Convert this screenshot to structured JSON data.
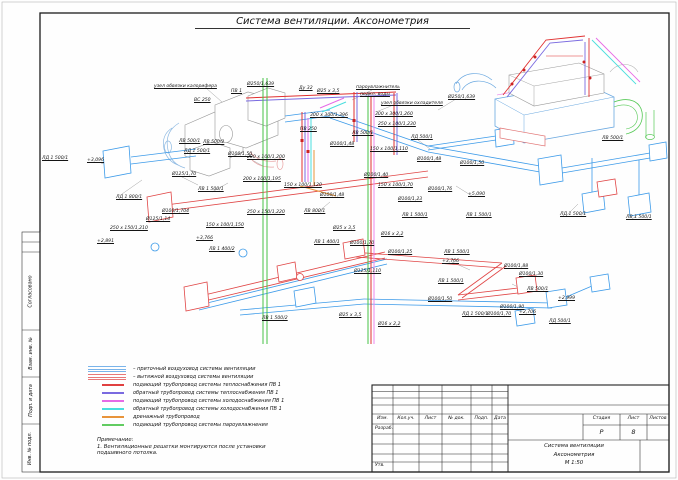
{
  "sheet": {
    "title": "Система вентиляции. Аксонометрия"
  },
  "frame": {
    "left_stamps": [
      {
        "label": "Согласовано"
      },
      {
        "label": "Взам. инв. №"
      },
      {
        "label": "Подп. и дата"
      },
      {
        "label": "Инв. № подл."
      }
    ]
  },
  "legend": {
    "items": [
      {
        "label": "– приточный воздуховод системы вентиляции",
        "color": "#7ab4ea",
        "style": "triple"
      },
      {
        "label": "– вытяжной воздуховод системы вентиляции",
        "color": "#e87878",
        "style": "triple"
      },
      {
        "label": "подающий трубопровод системы теплоснабжения ПВ 1",
        "color": "#e04040",
        "style": "single"
      },
      {
        "label": "обратный трубопровод системы теплоснабжения ПВ 1",
        "color": "#7a6ae0",
        "style": "single"
      },
      {
        "label": "подающий трубопровод системы холодоснабжения ПВ 1",
        "color": "#e66ae6",
        "style": "single"
      },
      {
        "label": "обратный трубопровод системы холодоснабжения ПВ 1",
        "color": "#4adede",
        "style": "single"
      },
      {
        "label": "дренажный трубопровод",
        "color": "#e8943a",
        "style": "single"
      },
      {
        "label": "подающий трубопровод системы пароувлажнения",
        "color": "#62cc62",
        "style": "single"
      }
    ]
  },
  "note": {
    "heading": "Примечание:",
    "lines": [
      "1. Вентиляционные решетки монтируются после установки",
      "подшивного потолка."
    ]
  },
  "title_block": {
    "columns": [
      "Изм.",
      "Кол.уч.",
      "Лист",
      "№ док.",
      "Подп.",
      "Дата"
    ],
    "row_developed": "Разраб.",
    "row_approved": "Утв.",
    "stage_label": "Стадия",
    "sheet_label": "Лист",
    "sheets_label": "Листов",
    "stage_value": "Р",
    "sheet_value": "8",
    "sheets_value": "",
    "doc_title_lines": [
      "Система вентиляции",
      "Аксонометрия",
      "М 1:50"
    ]
  },
  "drawing": {
    "colors": {
      "supply_duct": "#3d9be9",
      "exhaust_duct": "#e04545",
      "heat_supply": "#e03030",
      "heat_return": "#7a6ae0",
      "cool_supply": "#e66ae6",
      "cool_return": "#4adede",
      "drain": "#e8943a",
      "steam": "#46c246"
    },
    "labels": [
      {
        "t": "узел обвязки калорифера",
        "x": 154,
        "y": 84
      },
      {
        "t": "ПВ 1",
        "x": 231,
        "y": 89
      },
      {
        "t": "Ø250/1,639",
        "x": 247,
        "y": 82
      },
      {
        "t": "ВС 250",
        "x": 194,
        "y": 98
      },
      {
        "t": "Ду 32",
        "x": 299,
        "y": 86
      },
      {
        "t": "Ø25 х 3,5",
        "x": 317,
        "y": 89
      },
      {
        "t": "пароувлажнитель",
        "x": 356,
        "y": 85
      },
      {
        "t": "подкл. воды",
        "x": 360,
        "y": 92
      },
      {
        "t": "узел обвязки охладителя",
        "x": 381,
        "y": 101
      },
      {
        "t": "Ø250/1,639",
        "x": 448,
        "y": 95
      },
      {
        "t": "300 х 300/1,396",
        "x": 310,
        "y": 113
      },
      {
        "t": "300 х 300/1,260",
        "x": 375,
        "y": 112
      },
      {
        "t": "250 х 100/1,230",
        "x": 378,
        "y": 122
      },
      {
        "t": "ПВ 250",
        "x": 300,
        "y": 127
      },
      {
        "t": "Ø100/1,48",
        "x": 330,
        "y": 142
      },
      {
        "t": "ЛВ 500/1",
        "x": 352,
        "y": 131
      },
      {
        "t": "+3,096",
        "x": 87,
        "y": 158
      },
      {
        "t": "ЛД 1 800/1",
        "x": 116,
        "y": 195
      },
      {
        "t": "Ø125/1,70",
        "x": 172,
        "y": 172
      },
      {
        "t": "ЛВ 500/2",
        "x": 203,
        "y": 140
      },
      {
        "t": "ЛД 1 500/1",
        "x": 184,
        "y": 149
      },
      {
        "t": "Ø100/1,50",
        "x": 228,
        "y": 152
      },
      {
        "t": "200 х 100/1,200",
        "x": 247,
        "y": 155
      },
      {
        "t": "ЛВ 1 500/1",
        "x": 198,
        "y": 187
      },
      {
        "t": "200 х 100/1,195",
        "x": 243,
        "y": 177
      },
      {
        "t": "150 х 100/1,120",
        "x": 284,
        "y": 183
      },
      {
        "t": "Ø100/1,48",
        "x": 320,
        "y": 193
      },
      {
        "t": "ЛВ 800/1",
        "x": 304,
        "y": 209
      },
      {
        "t": "250 х 150/1,220",
        "x": 247,
        "y": 210
      },
      {
        "t": "150 х 100/1,150",
        "x": 206,
        "y": 223
      },
      {
        "t": "250 х 150/1,210",
        "x": 110,
        "y": 226
      },
      {
        "t": "Ø125/1,14",
        "x": 146,
        "y": 217
      },
      {
        "t": "Ø100/1,704",
        "x": 162,
        "y": 209
      },
      {
        "t": "+2,891",
        "x": 97,
        "y": 239
      },
      {
        "t": "+3,766",
        "x": 196,
        "y": 236
      },
      {
        "t": "ЛВ 1 400/2",
        "x": 209,
        "y": 247
      },
      {
        "t": "ЛВ 1 400/1",
        "x": 314,
        "y": 240
      },
      {
        "t": "ЛВ 1 500/2",
        "x": 262,
        "y": 316
      },
      {
        "t": "ЛД 500/1",
        "x": 411,
        "y": 135
      },
      {
        "t": "150 х 100/1,110",
        "x": 370,
        "y": 147
      },
      {
        "t": "Ø100/1,48",
        "x": 417,
        "y": 157
      },
      {
        "t": "Ø100/1,50",
        "x": 460,
        "y": 161
      },
      {
        "t": "Ø100/1,40",
        "x": 364,
        "y": 173
      },
      {
        "t": "150 х 100/1,70",
        "x": 378,
        "y": 183
      },
      {
        "t": "Ø100/1,76",
        "x": 428,
        "y": 187
      },
      {
        "t": "Ø100/1,23",
        "x": 398,
        "y": 197
      },
      {
        "t": "+5,090",
        "x": 468,
        "y": 192
      },
      {
        "t": "ЛВ 1 500/1",
        "x": 402,
        "y": 213
      },
      {
        "t": "ЛВ 1 500/1",
        "x": 466,
        "y": 213
      },
      {
        "t": "ЛД 1 500/1",
        "x": 560,
        "y": 212
      },
      {
        "t": "ЛВ 1 500/1",
        "x": 626,
        "y": 215
      },
      {
        "t": "ЛВ 500/1",
        "x": 602,
        "y": 136
      },
      {
        "t": "Ø25 х 3,5",
        "x": 333,
        "y": 226
      },
      {
        "t": "Ø16 х 2,2",
        "x": 381,
        "y": 232
      },
      {
        "t": "Ø25 х 3,5",
        "x": 339,
        "y": 313
      },
      {
        "t": "Ø16 х 2,2",
        "x": 378,
        "y": 322
      },
      {
        "t": "Ø100/1,70",
        "x": 350,
        "y": 241
      },
      {
        "t": "Ø100/1,25",
        "x": 388,
        "y": 250
      },
      {
        "t": "ЛВ 1 500/1",
        "x": 444,
        "y": 250
      },
      {
        "t": "+3,766",
        "x": 442,
        "y": 259
      },
      {
        "t": "Ø125/1,110",
        "x": 354,
        "y": 269
      },
      {
        "t": "ЛВ 1 500/1",
        "x": 438,
        "y": 279
      },
      {
        "t": "Ø100/1,50",
        "x": 428,
        "y": 297
      },
      {
        "t": "ЛД 1 500/1",
        "x": 462,
        "y": 312
      },
      {
        "t": "Ø100/1,90",
        "x": 500,
        "y": 305
      },
      {
        "t": "Ø100/1,88",
        "x": 504,
        "y": 264
      },
      {
        "t": "Ø100/1,30",
        "x": 519,
        "y": 272
      },
      {
        "t": "ЛВ 500/1",
        "x": 527,
        "y": 287
      },
      {
        "t": "+2,999",
        "x": 558,
        "y": 296
      },
      {
        "t": "Ø100/1,70",
        "x": 487,
        "y": 312
      },
      {
        "t": "+2,706",
        "x": 519,
        "y": 310
      },
      {
        "t": "ЛД 500/1",
        "x": 549,
        "y": 319
      },
      {
        "t": "ЛД 1 500/1",
        "x": 42,
        "y": 156
      },
      {
        "t": "ЛВ 500/1",
        "x": 179,
        "y": 139
      }
    ]
  }
}
